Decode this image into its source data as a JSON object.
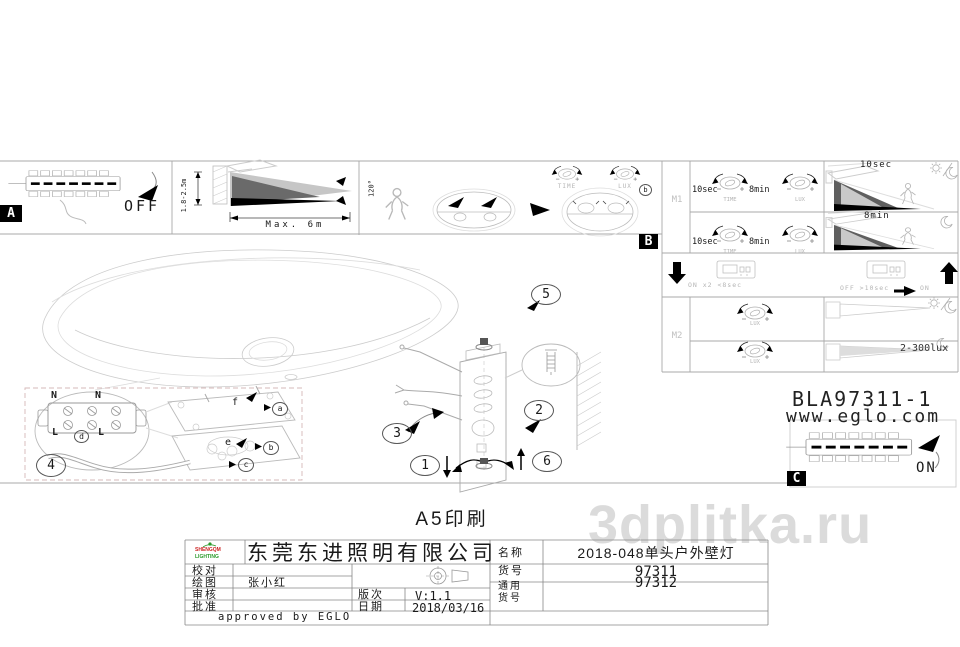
{
  "watermark": "3dplitka.ru",
  "sections": {
    "a": {
      "label": "A",
      "power": "OFF"
    },
    "b": {
      "label": "B",
      "detail": "b"
    },
    "c": {
      "label": "C",
      "power": "ON"
    },
    "range": {
      "height": "1.8-2.5m",
      "distance": "Max. 6m",
      "angle": "120°"
    }
  },
  "settings": {
    "m1": "M1",
    "m2": "M2",
    "time_min": "10sec",
    "time_max": "8min",
    "time": "TIME",
    "lux": "LUX",
    "beam1": "10sec",
    "beam2": "8min",
    "reset_on": "ON x2 <8sec",
    "reset_off": "OFF >10sec",
    "reset_to": "ON",
    "lux_range": "2-300lux"
  },
  "product": {
    "code": "BLA97311-1",
    "website": "www.eglo.com"
  },
  "assembly": {
    "steps": [
      "1",
      "2",
      "3",
      "4",
      "5",
      "6"
    ],
    "terminals": {
      "n": "N",
      "l": "L",
      "d": "d"
    },
    "parts": {
      "a": "a",
      "b": "b",
      "c": "c",
      "e": "e",
      "f": "f"
    }
  },
  "title_block": {
    "print": "A5印刷",
    "company": "东莞东进照明有限公司",
    "logo1": "SHENGQM",
    "logo2": "LIGHTING",
    "check": "校对",
    "draw": "绘图",
    "draw_value": "张小红",
    "review": "审核",
    "approve": "批准",
    "version_label": "版次",
    "version": "V:1.1",
    "date_label": "日期",
    "date": "2018/03/16",
    "name_label": "名称",
    "name": "2018-048单头户外壁灯",
    "item_label": "货号",
    "item": "97311",
    "common_label1": "通用",
    "common_label2": "货号",
    "common": "97312",
    "approved": "approved by EGLO"
  }
}
